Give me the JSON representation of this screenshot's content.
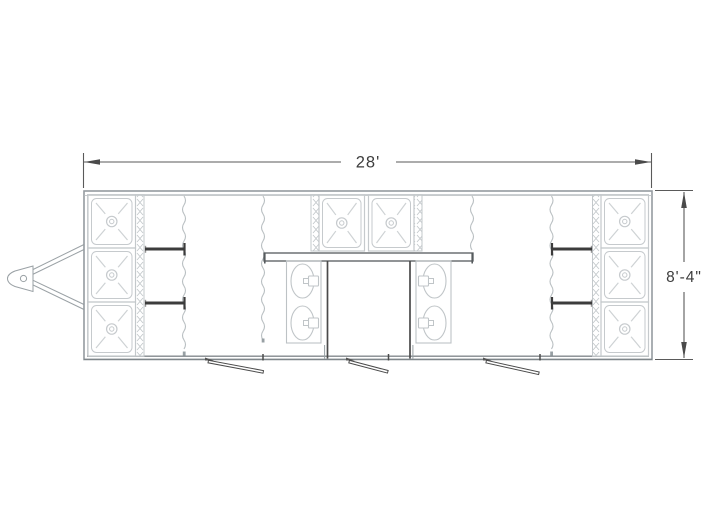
{
  "drawing": {
    "title": "trailer-floor-plan",
    "dimensions": {
      "overall_width": "28'",
      "overall_height": "8'-4\""
    },
    "fixtures": {
      "shower_stalls": 8,
      "sinks": 4,
      "doors": 3,
      "hitch": 1,
      "curtains": 4
    },
    "colors": {
      "background": "#ffffff",
      "line_light": "#c6cacd",
      "line_wall": "#949ba0",
      "line_dark": "#4a4a4a",
      "partition_dark": "#3c3c3c",
      "dim_text": "#3d3d3d"
    }
  }
}
